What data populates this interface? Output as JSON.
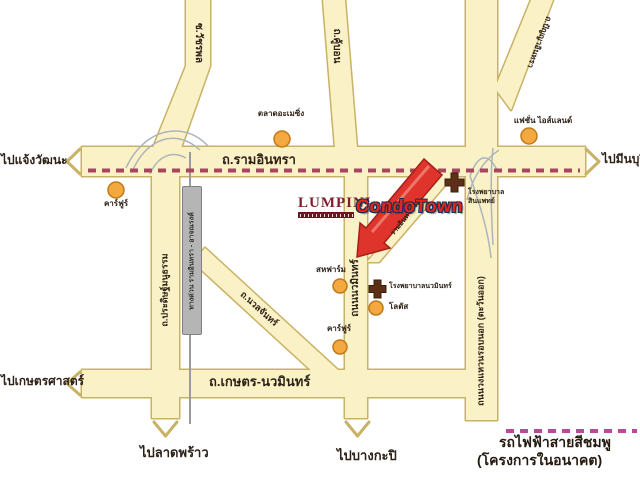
{
  "logo": {
    "brand": "LUMPINI",
    "product": "CondoTown"
  },
  "roads": {
    "ramindra": "ถ.รามอินทรา",
    "kaset_nawamin": "ถ.เกษตร-นวมินทร์",
    "watcharaphon": "ซ.วัชรพล",
    "khubon": "ถ.คู้บอน",
    "panya_indra": "ถ.ปัญญาอินทรา",
    "pradit_manutham": "ถ.ประดิษฐ์มนูธรรม",
    "expressway": "ทางด่วน รามอินทรา - อาจณรงค์",
    "nawamin": "ถนนนวมินทร์",
    "ring_road": "ถนนวงแหวนรอบนอก (ตะวันออก)",
    "nuanchan": "ถ.นวลจันทร์",
    "soi": "รามอินทรา 52"
  },
  "landmarks": {
    "market": "ตลาดอะเมซิ่ง",
    "carrefour_west": "คาร์ฟูร์",
    "fashion_island": "แฟชั่น ไอส์แลนด์",
    "saha_farm": "สหฟาร์ม",
    "hospital_synphaet_line1": "โรงพยาบาล",
    "hospital_synphaet_line2": "สินแพทย์",
    "hospital_nawamin": "โรงพยาบาลนวมินทร์",
    "lotus": "โลตัส",
    "carrefour_south": "คาร์ฟูร์"
  },
  "directions": {
    "chaengwattana": "ไปแจ้งวัฒนะ",
    "minburi": "ไปมีนบุรี",
    "kasetsart": "ไปเกษตรศาสตร์",
    "latphrao": "ไปลาดพร้าว",
    "bangkapi": "ไปบางกะปิ"
  },
  "legend": {
    "line1": "รถไฟฟ้าสายสีชมพู",
    "line2": "(โครงการในอนาคต)"
  },
  "colors": {
    "road_fill": "#FAF2C6",
    "road_border": "#C8B264",
    "pink_line": "#A84560",
    "legend_pink": "#B84A9E",
    "arrow_red": "#DE342B",
    "dot_orange": "#F3A93F",
    "cross_brown": "#5E2F17"
  }
}
